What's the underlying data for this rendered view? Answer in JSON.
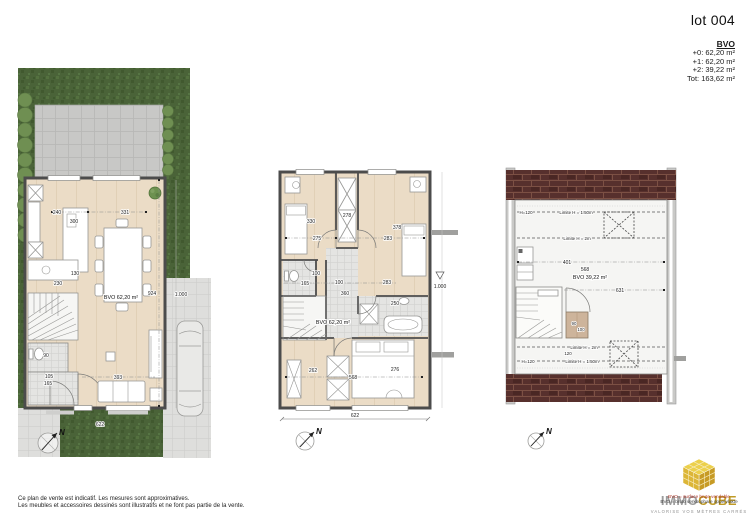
{
  "doc": {
    "lot_title": "lot 004",
    "bvo_heading": "BVO",
    "bvo_rows": [
      "+0: 62,20 m²",
      "+1: 62,20 m²",
      "+2: 39,22 m²",
      "Tot: 163,62 m²"
    ],
    "footer_line1": "Ce plan de vente est indicatif. Les mesures sont approximatives.",
    "footer_line2": "Les meubles et accessoires dessinés sont illustratifs et ne font pas partie de la vente."
  },
  "logo": {
    "brand_gray": "IMMO",
    "brand_gold": "CUBE",
    "legend_line1": "BVO = surface brute vendable",
    "legend_line2": "BVO = bruto verkoopbare oppervlakte",
    "tagline": "VALORISE VOS MÈTRES CARRÉS"
  },
  "plans": {
    "ground": {
      "bvo_label": "BVO 62,20 m²",
      "north": "N",
      "dims": {
        "island_w": "240",
        "island_l": "300",
        "dining": "331",
        "counter": "130",
        "kitchen": "230",
        "depth": "924",
        "sofa": "393",
        "width": "622",
        "wc": "90",
        "hall_a": "105",
        "hall_b": "165",
        "level": "1.000"
      }
    },
    "first": {
      "bvo_label": "BVO 62,20 m²",
      "north": "N",
      "dims": {
        "bed1_l": "330",
        "bed1_w": "275",
        "wardrobe": "278",
        "bed2_l": "378",
        "bed2_w": "283",
        "wc_w": "100",
        "wc_l": "165",
        "landing_w": "100",
        "landing_l": "360",
        "bath_w": "283",
        "bath_l": "250",
        "bed3_a": "262",
        "bed3_l": "568",
        "bed3_w": "276",
        "width": "622",
        "level": "1.000"
      }
    },
    "attic": {
      "bvo_label": "BVO 39,22 m²",
      "north": "N",
      "dims": {
        "h120_top": "H=120",
        "lim150_top": "Limite H = 1.50m",
        "lim2_top": "Limite H = 2m",
        "a": "401",
        "b": "568",
        "c": "631",
        "lim2_bot": "Limite H = 2m",
        "lim150_bot": "Limite H = 1.50m",
        "h120_bot": "H=120",
        "d": "120",
        "cab_a": "90",
        "cab_b": "100"
      }
    }
  }
}
